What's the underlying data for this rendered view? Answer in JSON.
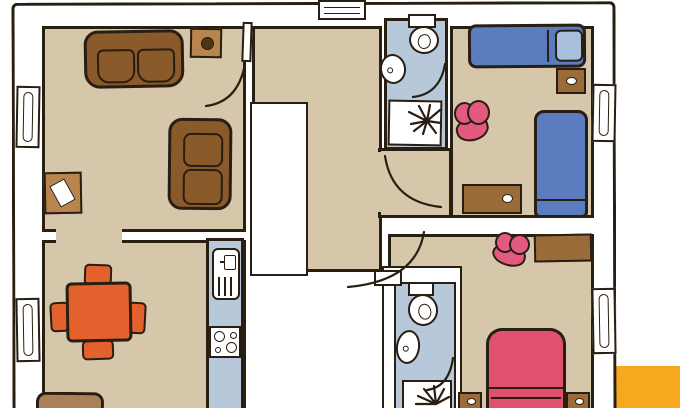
{
  "scene": {
    "type": "apartment floor plan",
    "style": "hand-drawn color illustration, top-down view",
    "visible_text": []
  },
  "rooms": [
    {
      "id": "living-room",
      "position": "top-left",
      "floor": "tan",
      "furniture": [
        "two-seat sofa (horizontal)",
        "two-seat sofa (vertical)",
        "side table with dark ring",
        "small table with paper sheet"
      ]
    },
    {
      "id": "dining-kitchen",
      "position": "bottom-left",
      "floor": "tan",
      "furniture": [
        "orange dining table",
        "4 orange chairs",
        "blue kitchen counter strip",
        "sink unit",
        "stove with 4 burners",
        "brown rug"
      ]
    },
    {
      "id": "hall",
      "position": "center",
      "floor": "tan",
      "features": [
        "white stair void",
        "entrance door arc",
        "living room door leaf"
      ]
    },
    {
      "id": "bathroom-top",
      "position": "top-center",
      "floor": "light-blue",
      "fixtures": [
        "toilet with cistern",
        "washbasin",
        "shower tray with spray"
      ]
    },
    {
      "id": "bedroom-top-right",
      "position": "top-right",
      "floor": "tan",
      "furniture": [
        "single bed with pillow (horizontal)",
        "single bed (vertical)",
        "nightstand with knob",
        "pink armchair",
        "desk with knob"
      ]
    },
    {
      "id": "bedroom-bottom-right",
      "position": "bottom-right",
      "floor": "tan",
      "furniture": [
        "crimson double bed",
        "left nightstand",
        "right nightstand",
        "brown dresser",
        "pink chair"
      ]
    },
    {
      "id": "bathroom-bottom",
      "position": "bottom-center",
      "floor": "light-blue",
      "fixtures": [
        "toilet with cistern",
        "washbasin",
        "shower tray with spray"
      ]
    }
  ],
  "windows": {
    "top_wall": 1,
    "left_wall": 2,
    "right_wall": 2
  },
  "door_arcs": 5,
  "decor": {
    "yellow_corner_block": true
  },
  "palette": {
    "ink": "#281e12",
    "floor": "#d6c7ab",
    "bath": "#b6c8da",
    "wall": "#ffffff",
    "sofaBrown": "#8a5a2b",
    "lightBrown": "#b9854e",
    "woodBrown": "#9c6b3a",
    "rug": "#aa8159",
    "bedBlue": "#5b7cbe",
    "pillowBlue": "#a9c0dc",
    "crimson": "#e0506f",
    "pink": "#e35a80",
    "orange": "#e2612d",
    "yellow": "#f6a91f",
    "knobDark": "#50341a"
  }
}
